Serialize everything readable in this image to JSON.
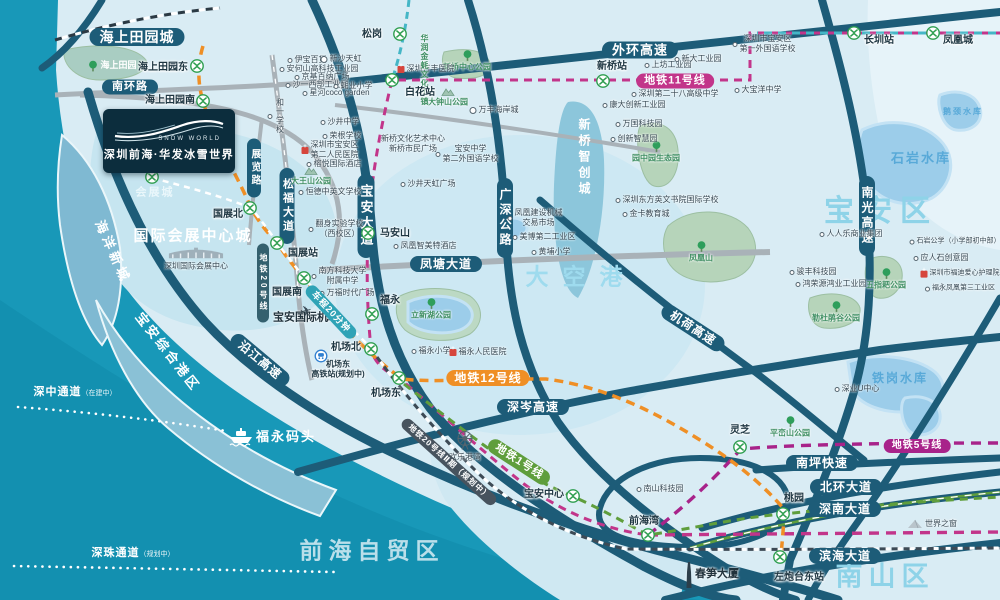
{
  "logo": {
    "brand_cn": "深圳前海·华发冰雪世界",
    "brand_en": "SNOW WORLD"
  },
  "colors": {
    "sea": "#1898b8",
    "land": "#d9ecf4",
    "road_dark": "#1d5c78",
    "road_gray": "#a9b2b8",
    "line11": "#c2358a",
    "line12": "#ef8f25",
    "line1": "#5f9e3c",
    "line5": "#a8238a",
    "line6": "#45b6c6",
    "rail_dark": "#47535e",
    "metro_green": "#2e9e4f",
    "water": "#9ccdea",
    "park": "#b6d4ba"
  },
  "road_banners": [
    {
      "label": "海上田园城",
      "x": 137,
      "y": 37,
      "fs": 14
    },
    {
      "label": "南环路",
      "x": 130,
      "y": 87,
      "fs": 11
    },
    {
      "label": "外环高速",
      "x": 640,
      "y": 50,
      "fs": 13
    },
    {
      "label": "凤塘大道",
      "x": 446,
      "y": 264,
      "fs": 12
    },
    {
      "label": "深岑高速",
      "x": 533,
      "y": 407,
      "fs": 12
    },
    {
      "label": "南坪快速",
      "x": 822,
      "y": 463,
      "fs": 12
    },
    {
      "label": "北环大道",
      "x": 846,
      "y": 487,
      "fs": 12
    },
    {
      "label": "深南大道",
      "x": 845,
      "y": 509,
      "fs": 12
    },
    {
      "label": "滨海大道",
      "x": 845,
      "y": 556,
      "fs": 12
    },
    {
      "label": "宝安大道",
      "x": 366,
      "y": 216,
      "fs": 13,
      "vert": true
    },
    {
      "label": "广深公路",
      "x": 505,
      "y": 218,
      "fs": 12,
      "vert": true
    },
    {
      "label": "松福大道",
      "x": 287,
      "y": 206,
      "fs": 11,
      "vert": true
    },
    {
      "label": "展览路",
      "x": 254,
      "y": 168,
      "fs": 10,
      "vert": true
    },
    {
      "label": "南光高速",
      "x": 867,
      "y": 216,
      "fs": 12,
      "vert": true
    },
    {
      "label": "沿江高速",
      "x": 260,
      "y": 360,
      "fs": 12,
      "rot": 40
    },
    {
      "label": "机荷高速",
      "x": 693,
      "y": 328,
      "fs": 12,
      "rot": 33
    }
  ],
  "metro_badges": [
    {
      "label": "地铁11号线",
      "x": 675,
      "y": 81,
      "color": "#c2358a",
      "fs": 11
    },
    {
      "label": "地铁12号线",
      "x": 488,
      "y": 378,
      "color": "#ef8f25",
      "fs": 12
    },
    {
      "label": "地铁1号线",
      "x": 519,
      "y": 462,
      "color": "#5f9e3c",
      "fs": 11,
      "rot": 33
    },
    {
      "label": "地铁5号线",
      "x": 917,
      "y": 446,
      "color": "#a8238a",
      "fs": 10
    },
    {
      "label": "地铁20号线Ⅱ期（规划中）",
      "x": 449,
      "y": 462,
      "color": "#47535e",
      "fs": 8,
      "rot": 42
    },
    {
      "label": "地铁20号线",
      "x": 263,
      "y": 283,
      "color": "#34606e",
      "fs": 8,
      "vert": true
    },
    {
      "label": "车程20分钟",
      "x": 331,
      "y": 312,
      "color": "#2fa3b6",
      "fs": 9,
      "rot": 47
    }
  ],
  "stations": [
    {
      "name": "松岗",
      "ix": 400,
      "iy": 34,
      "lx": 372,
      "ly": 35
    },
    {
      "name": "海上田园东",
      "ix": 197,
      "iy": 66,
      "lx": 163,
      "ly": 68
    },
    {
      "name": "海上田园南",
      "ix": 203,
      "iy": 101,
      "lx": 170,
      "ly": 101
    },
    {
      "name": "白花站",
      "ix": 392,
      "iy": 80,
      "lx": 420,
      "ly": 93
    },
    {
      "name": "新桥站",
      "ix": 603,
      "iy": 81,
      "lx": 612,
      "ly": 67
    },
    {
      "name": "长圳站",
      "ix": 854,
      "iy": 33,
      "lx": 879,
      "ly": 41
    },
    {
      "name": "凤凰城",
      "ix": 933,
      "iy": 33,
      "lx": 958,
      "ly": 41
    },
    {
      "name": "会展城",
      "ix": 152,
      "iy": 177,
      "hideLabel": true,
      "lx": 155,
      "ly": 192
    },
    {
      "name": "国展北",
      "ix": 250,
      "iy": 208,
      "lx": 228,
      "ly": 215
    },
    {
      "name": "国展站",
      "ix": 277,
      "iy": 243,
      "lx": 303,
      "ly": 254
    },
    {
      "name": "国展南",
      "ix": 304,
      "iy": 278,
      "lx": 287,
      "ly": 293
    },
    {
      "name": "马安山",
      "ix": 368,
      "iy": 233,
      "lx": 395,
      "ly": 234
    },
    {
      "name": "福永",
      "ix": 372,
      "iy": 314,
      "lx": 390,
      "ly": 301
    },
    {
      "name": "机场北",
      "ix": 371,
      "iy": 349,
      "lx": 346,
      "ly": 348
    },
    {
      "name": "机场东",
      "ix": 399,
      "iy": 378,
      "lx": 386,
      "ly": 394
    },
    {
      "name": "宝安中心",
      "ix": 573,
      "iy": 496,
      "lx": 544,
      "ly": 495
    },
    {
      "name": "前海湾",
      "ix": 648,
      "iy": 535,
      "lx": 644,
      "ly": 522
    },
    {
      "name": "灵芝",
      "ix": 740,
      "iy": 447,
      "lx": 740,
      "ly": 431
    },
    {
      "name": "桃园",
      "ix": 783,
      "iy": 514,
      "lx": 794,
      "ly": 499
    },
    {
      "name": "左炮台东站",
      "ix": 780,
      "iy": 557,
      "lx": 799,
      "ly": 578
    }
  ],
  "hsr_station": {
    "icon_x": 321,
    "icon_y": 356,
    "lines": [
      "机场东",
      "高铁站(规划中)"
    ],
    "x": 338,
    "y": 369
  },
  "districts": [
    {
      "label": "宝安区",
      "x": 881,
      "y": 212,
      "fs": 30,
      "color": "#8ed3e8",
      "ls": 8
    },
    {
      "label": "南山区",
      "x": 885,
      "y": 577,
      "fs": 27,
      "color": "#8ed3e8",
      "ls": 6
    },
    {
      "label": "大空港",
      "x": 581,
      "y": 277,
      "fs": 23,
      "color": "#9edbee",
      "ls": 14
    },
    {
      "label": "前海自贸区",
      "x": 372,
      "y": 551,
      "fs": 23,
      "color": "#d8edf5",
      "ls": 6,
      "op": 0.85
    },
    {
      "label": "国际会展中心城",
      "x": 193,
      "y": 236,
      "fs": 15,
      "color": "#ffffff",
      "ls": 2
    },
    {
      "label": "海洋新城",
      "x": 113,
      "y": 252,
      "fs": 13,
      "color": "#ffffff",
      "ls": 4,
      "rot": 66
    },
    {
      "label": "宝安综合港区",
      "x": 168,
      "y": 352,
      "fs": 13,
      "color": "#ffffff",
      "ls": 3,
      "rot": 52
    },
    {
      "label": "新桥智创城",
      "x": 584,
      "y": 158,
      "fs": 12,
      "color": "#ffffff",
      "ls": 4,
      "vert": true
    },
    {
      "label": "会展城",
      "x": 155,
      "y": 193,
      "fs": 11,
      "color": "#eaf7fb",
      "ls": 2
    }
  ],
  "water_labels": [
    {
      "label": "石岩水库",
      "x": 921,
      "y": 158,
      "fs": 13
    },
    {
      "label": "铁岗水库",
      "x": 900,
      "y": 378,
      "fs": 12
    },
    {
      "label": "鹅颈水库",
      "x": 963,
      "y": 112,
      "fs": 8
    }
  ],
  "park_labels": [
    {
      "label": "新桥中心公园",
      "x": 467,
      "y": 61,
      "icon": "tree"
    },
    {
      "label": "大钟山公园",
      "x": 448,
      "y": 97,
      "icon": "mountain"
    },
    {
      "label": "大王山公园",
      "x": 311,
      "y": 176,
      "icon": "mountain"
    },
    {
      "label": "凤凰山",
      "x": 701,
      "y": 252,
      "icon": "tree"
    },
    {
      "label": "五指耙公园",
      "x": 886,
      "y": 279,
      "icon": "tree"
    },
    {
      "label": "勒杜鹃谷公园",
      "x": 836,
      "y": 312,
      "icon": "tree"
    },
    {
      "label": "立新湖公园",
      "x": 431,
      "y": 309,
      "icon": "tree"
    },
    {
      "label": "平峦山公园",
      "x": 790,
      "y": 427,
      "icon": "tree"
    },
    {
      "label": "园中园生态园",
      "x": 656,
      "y": 152,
      "icon": "tree"
    }
  ],
  "pois": [
    {
      "lines": [
        "伊宝百货"
      ],
      "x": 307,
      "y": 60,
      "icon": "dot"
    },
    {
      "lines": [
        "新沙天虹"
      ],
      "x": 341,
      "y": 59,
      "icon": "dotlg"
    },
    {
      "lines": [
        "安何山高科技工业园"
      ],
      "x": 319,
      "y": 69,
      "icon": "dot"
    },
    {
      "lines": [
        "京基百纳广场"
      ],
      "x": 322,
      "y": 77,
      "icon": "dot"
    },
    {
      "lines": [
        "沙一西部工业园"
      ],
      "x": 317,
      "y": 85,
      "icon": "dot"
    },
    {
      "lines": [
        "蚝业小学"
      ],
      "x": 353,
      "y": 86,
      "icon": "dot"
    },
    {
      "lines": [
        "星河coco garden"
      ],
      "x": 336,
      "y": 93,
      "icon": "dot"
    },
    {
      "lines": [
        "和一学校"
      ],
      "x": 276,
      "y": 116,
      "icon": "dot",
      "vert": true
    },
    {
      "lines": [
        "沙井中学"
      ],
      "x": 340,
      "y": 122,
      "icon": "dot"
    },
    {
      "lines": [
        "荣根学校"
      ],
      "x": 342,
      "y": 136,
      "icon": "dot"
    },
    {
      "lines": [
        "深圳市宝安区",
        "第二人民医院"
      ],
      "x": 330,
      "y": 150,
      "icon": "red"
    },
    {
      "lines": [
        "榕悦国际酒店"
      ],
      "x": 334,
      "y": 164,
      "icon": "dot"
    },
    {
      "lines": [
        "恒德中英文学校"
      ],
      "x": 330,
      "y": 192,
      "icon": "dot"
    },
    {
      "lines": [
        "翻身实验学校",
        "（西校区）"
      ],
      "x": 336,
      "y": 229,
      "icon": "dot"
    },
    {
      "lines": [
        "南方科技大学",
        "附属中学"
      ],
      "x": 339,
      "y": 276,
      "icon": "dot"
    },
    {
      "lines": [
        "万福时代广场"
      ],
      "x": 347,
      "y": 293,
      "icon": "dot"
    },
    {
      "lines": [
        "凤凰智美特酒店"
      ],
      "x": 425,
      "y": 246,
      "icon": "dot"
    },
    {
      "lines": [
        "福永小学"
      ],
      "x": 431,
      "y": 351,
      "icon": "dot"
    },
    {
      "lines": [
        "福永人民医院"
      ],
      "x": 478,
      "y": 352,
      "icon": "red"
    },
    {
      "lines": [
        "凤凰建设机械",
        "交易市场"
      ],
      "x": 535,
      "y": 218,
      "icon": "dot"
    },
    {
      "lines": [
        "美博第二工业区"
      ],
      "x": 544,
      "y": 237,
      "icon": "dot"
    },
    {
      "lines": [
        "黄埔小学"
      ],
      "x": 551,
      "y": 252,
      "icon": "dot"
    },
    {
      "lines": [
        "沙井天虹广场"
      ],
      "x": 428,
      "y": 184,
      "icon": "dot"
    },
    {
      "lines": [
        "新桥文化艺术中心",
        "新桥市民广场"
      ],
      "x": 413,
      "y": 144,
      "icon": "none"
    },
    {
      "lines": [
        "宝安中学",
        "第二外国语学校"
      ],
      "x": 467,
      "y": 154,
      "icon": "dot"
    },
    {
      "lines": [
        "深圳万丰医院"
      ],
      "x": 426,
      "y": 69,
      "icon": "red"
    },
    {
      "lines": [
        "万丰海岸城"
      ],
      "x": 494,
      "y": 110,
      "icon": "dotlg"
    },
    {
      "lines": [
        "华润金蚝文化小镇"
      ],
      "x": 424,
      "y": 62,
      "icon": "none",
      "vert": true,
      "h": 56,
      "cls": "park"
    },
    {
      "lines": [
        "上坊工业园"
      ],
      "x": 668,
      "y": 65,
      "icon": "dot"
    },
    {
      "lines": [
        "新大工业园"
      ],
      "x": 698,
      "y": 59,
      "icon": "dot"
    },
    {
      "lines": [
        "深圳第二十八高级中学"
      ],
      "x": 675,
      "y": 94,
      "icon": "dot"
    },
    {
      "lines": [
        "康大创新工业园"
      ],
      "x": 634,
      "y": 105,
      "icon": "dot"
    },
    {
      "lines": [
        "万国科技园"
      ],
      "x": 639,
      "y": 124,
      "icon": "dot"
    },
    {
      "lines": [
        "创新智慧园"
      ],
      "x": 634,
      "y": 139,
      "icon": "dot"
    },
    {
      "lines": [
        "深圳东方英文书院国际学校"
      ],
      "x": 667,
      "y": 200,
      "icon": "dot"
    },
    {
      "lines": [
        "金卡教育城"
      ],
      "x": 646,
      "y": 214,
      "icon": "dot"
    },
    {
      "lines": [
        "大宝洋中学"
      ],
      "x": 758,
      "y": 90,
      "icon": "dot"
    },
    {
      "lines": [
        "深圳市宝安区",
        "第一外国语学校"
      ],
      "x": 764,
      "y": 44,
      "icon": "dot"
    },
    {
      "lines": [
        "人人乐商业集团"
      ],
      "x": 851,
      "y": 234,
      "icon": "dot"
    },
    {
      "lines": [
        "骏丰科技园"
      ],
      "x": 813,
      "y": 272,
      "icon": "dot"
    },
    {
      "lines": [
        "鸿荣源鸿业工业园"
      ],
      "x": 831,
      "y": 284,
      "icon": "dot"
    },
    {
      "lines": [
        "石岩公学（小学部初中部）"
      ],
      "x": 955,
      "y": 242,
      "icon": "dot",
      "fs": 7
    },
    {
      "lines": [
        "应人石创意园"
      ],
      "x": 941,
      "y": 258,
      "icon": "dot"
    },
    {
      "lines": [
        "深圳市福迪爱心护理院"
      ],
      "x": 960,
      "y": 274,
      "icon": "red",
      "fs": 7
    },
    {
      "lines": [
        "福永凤凰第三工业区"
      ],
      "x": 960,
      "y": 289,
      "icon": "dot",
      "fs": 7
    },
    {
      "lines": [
        "深业U中心"
      ],
      "x": 857,
      "y": 389,
      "icon": "dot"
    },
    {
      "lines": [
        "南山科技园"
      ],
      "x": 660,
      "y": 489,
      "icon": "dot"
    },
    {
      "lines": [
        "世界之窗"
      ],
      "x": 932,
      "y": 524,
      "icon": "pyramid"
    },
    {
      "lines": [
        "春笋大厦"
      ],
      "x": 712,
      "y": 575,
      "icon": "tower",
      "cls": "bigpoi"
    },
    {
      "lines": [
        "欢乐港湾"
      ],
      "x": 465,
      "y": 446,
      "icon": "wheel",
      "col": true
    },
    {
      "lines": [
        "宝安国际机场"
      ],
      "x": 306,
      "y": 318,
      "icon": "plane",
      "col": true,
      "cls": "bigpoi"
    },
    {
      "lines": [
        "海上田园"
      ],
      "x": 112,
      "y": 66,
      "icon": "tree",
      "cls": "white"
    },
    {
      "lines": [
        "福永码头"
      ],
      "x": 272,
      "y": 437,
      "icon": "ship",
      "cls": "wharf"
    },
    {
      "lines": [
        "深圳国际会展中心"
      ],
      "x": 196,
      "y": 258,
      "icon": "expo",
      "col": true
    }
  ],
  "channels": [
    {
      "label": "深中通道",
      "note": "（在建中）",
      "x": 75,
      "y": 391
    },
    {
      "label": "深珠通道",
      "note": "（规划中）",
      "x": 133,
      "y": 552
    }
  ]
}
